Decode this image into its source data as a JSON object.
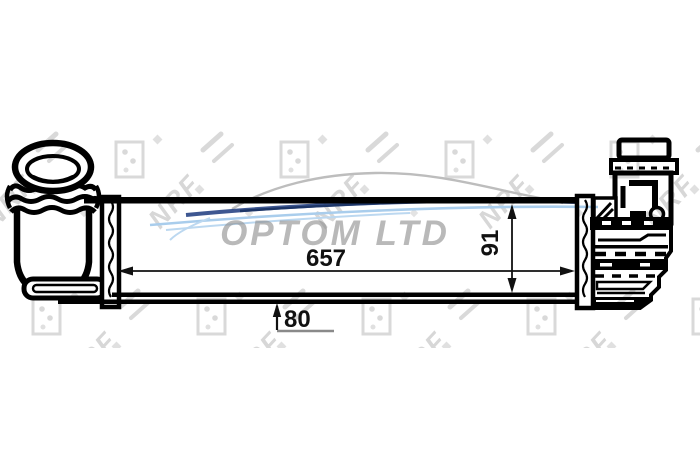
{
  "part_diagram": {
    "dimensions": {
      "length_label": "657",
      "height_label": "91",
      "depth_label": "80"
    }
  },
  "watermark": {
    "company": "OPTOM LTD",
    "brand": "NRF"
  },
  "colors": {
    "background": "#ffffff",
    "line": "#000000",
    "watermark_gray": "#d7d7d7",
    "company_gray": "#8f8f8f",
    "car_gray": "#bdbdbd",
    "swoosh_dark_blue": "#1c3a7e",
    "swoosh_light_blue": "#a9cdec",
    "dim_base_gray": "#8a8a8a"
  }
}
